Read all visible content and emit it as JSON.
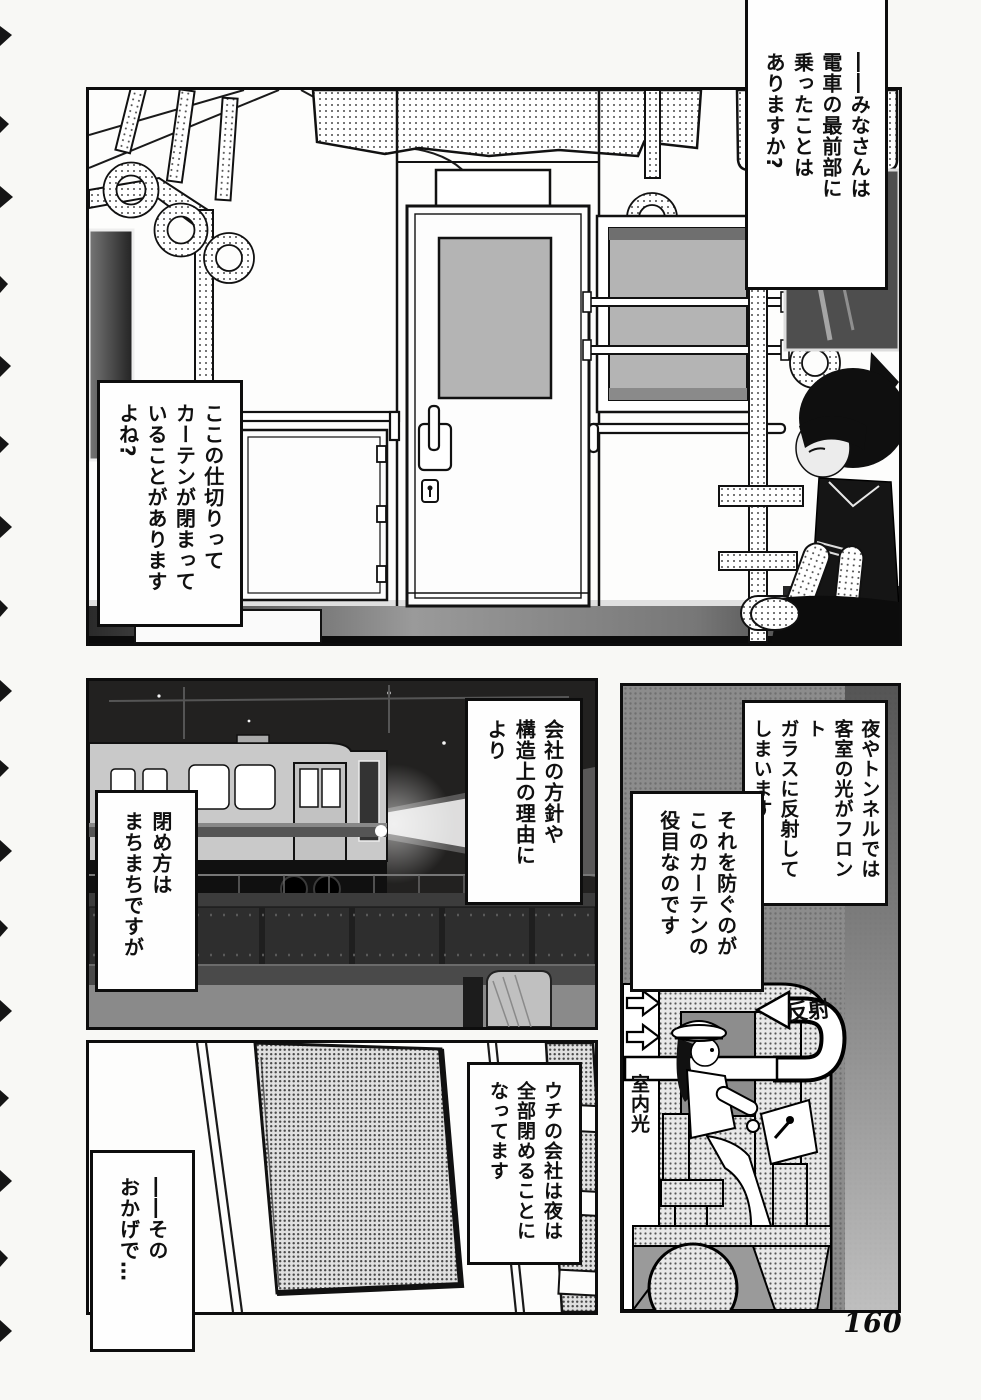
{
  "page": {
    "number": "160"
  },
  "speech": {
    "narrator_q1": "――みなさんは\n電車の最前部に\n乗ったことは\nありますか?",
    "narrator_q2": "ここの仕切りって\nカーテンが閉まって\nいることがあります\nよね?",
    "reply_policy": "会社の方針や\n構造上の理由に\nより",
    "reply_varies": "閉め方は\nまちまちですが",
    "explain_reflection": "夜やトンネルでは\n客室の光がフロント\nガラスに反射して\nしまいます",
    "explain_curtain": "それを防ぐのが\nこのカーテンの\n役目なのです",
    "company_rule": "ウチの会社は夜は\n全部閉めることに\nなってます",
    "thanks_to": "――その\nおかげで…"
  },
  "diagram": {
    "reflection_label": "反射",
    "room_light_label": "室内光"
  }
}
